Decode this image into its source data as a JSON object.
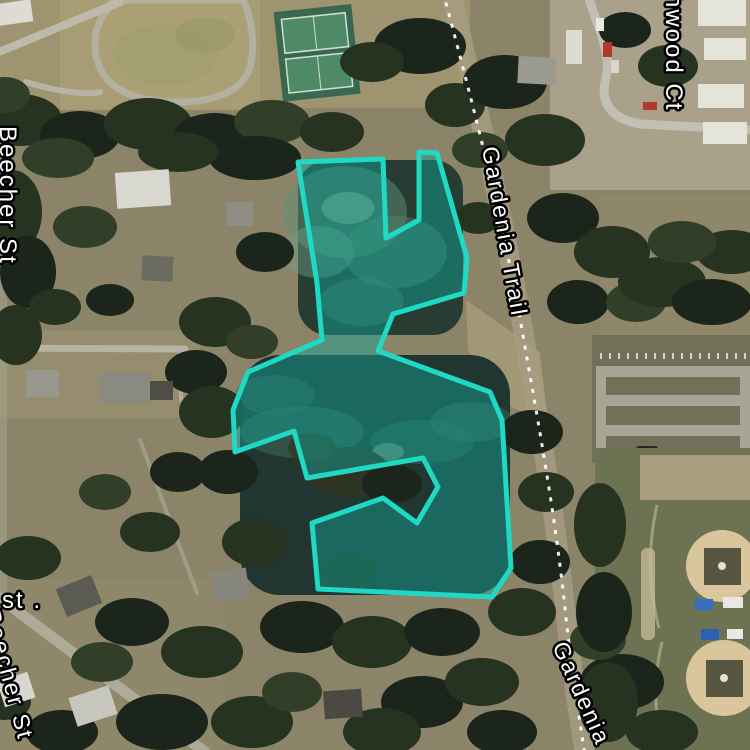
{
  "labels": {
    "beecher_st": "Beecher St",
    "beecher_st_fragment": "Beecher St",
    "gardenia_trail": "Gardenia Trail",
    "hwood_ct": "hwood Ct",
    "gardenia": "Gardenia",
    "st_fragment": "st ."
  },
  "label_style": {
    "fill": "#ffffff",
    "halo": "#000000"
  },
  "highlight": {
    "stroke_color": "#1fd9c5",
    "fill_color": "rgba(17,166,155,0.45)",
    "polygon_points": "298,162 383,159 386,238 419,220 419,152 437,153 467,258 464,293 393,314 378,351 490,392 502,420 511,568 492,597 318,589 312,523 383,498 417,523 438,487 423,458 307,478 294,431 235,452 233,410 248,372 322,340 317,283"
  },
  "trail": {
    "dash_color": "#ffffff"
  }
}
